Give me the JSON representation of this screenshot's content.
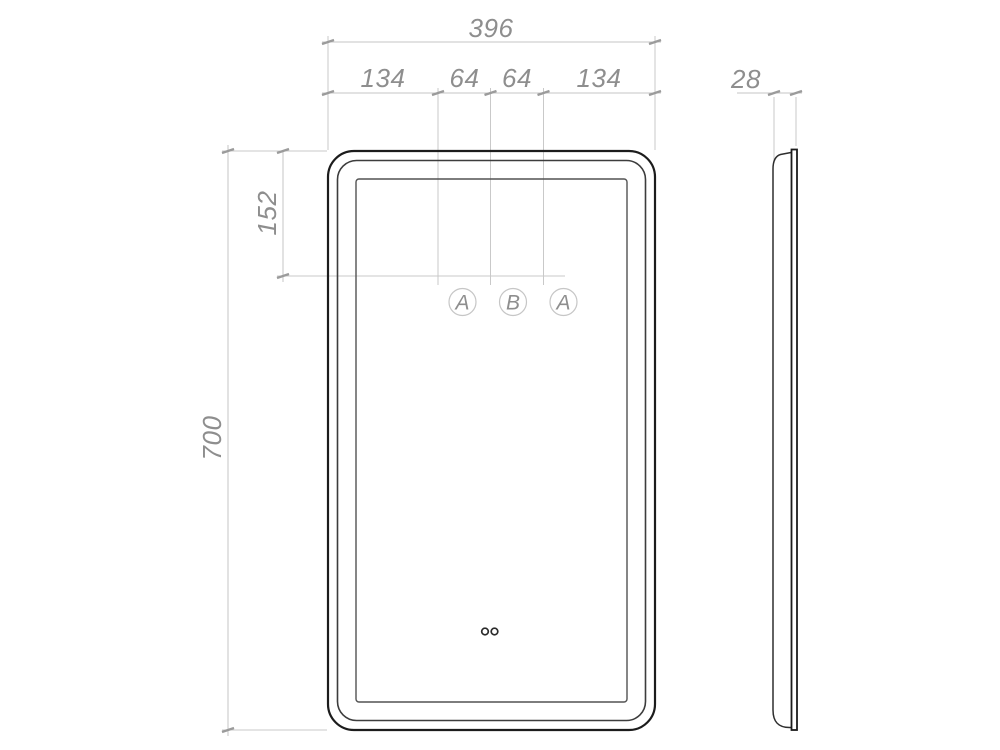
{
  "drawing": {
    "type": "technical-drawing",
    "subject": "led-mirror-dimension-drawing",
    "colors": {
      "background": "#ffffff",
      "object_line": "#1c1c1c",
      "secondary_line": "#3d3d3d",
      "inner_line": "#525252",
      "dimension_line": "#c6c6c6",
      "tick": "#9b9b9b",
      "dimension_text": "#8e8e8e"
    },
    "front_view": {
      "dimensions": {
        "overall_width": "396",
        "top_segments": [
          "134",
          "64",
          "64",
          "134"
        ],
        "sensor_offset_from_top": "152",
        "overall_height": "700"
      },
      "sensor_labels": [
        "A",
        "B",
        "A"
      ]
    },
    "side_view": {
      "dimensions": {
        "depth": "28"
      }
    }
  }
}
